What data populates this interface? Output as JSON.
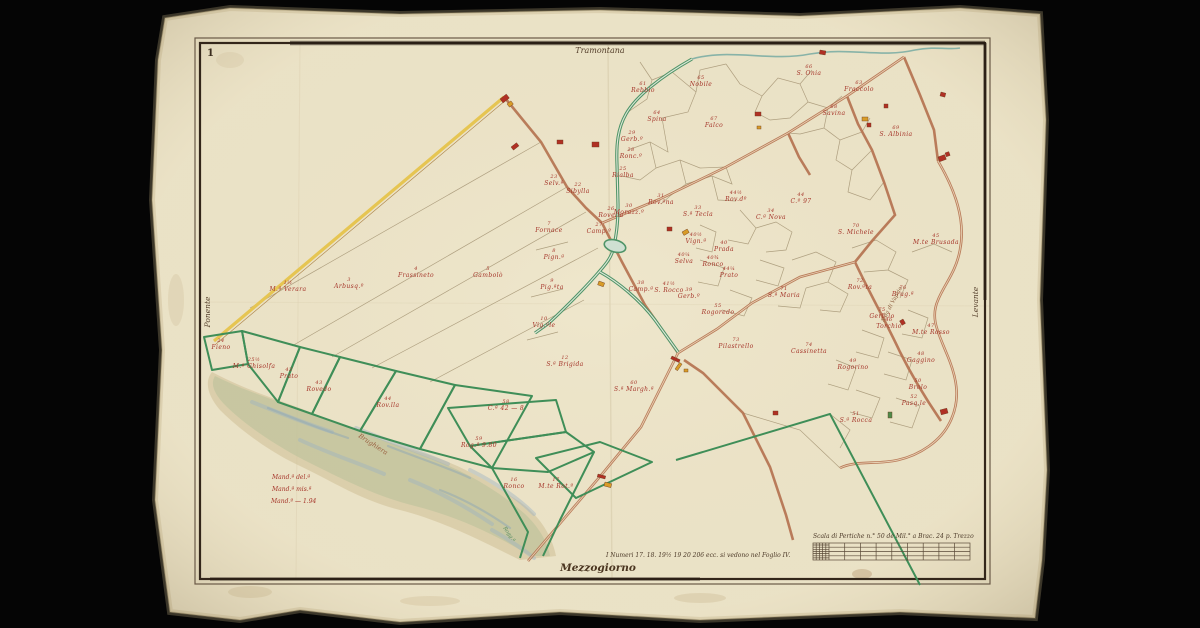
{
  "sheet": {
    "corner_number": "1"
  },
  "cardinals": {
    "north": "Tramontana",
    "south": "Mezzogiorno",
    "west": "Ponente",
    "east": "Levante"
  },
  "footnote": "I Numeri 17. 18. 19½ 19 20 206 ecc. si vedono nel Foglio IV.",
  "scale_bar": {
    "title": "Scala di Pertiche n.° 50 de Mil.° a Brac. 24 p. Trezzo"
  },
  "marsh_note": {
    "lines": [
      "Mand.ª del.ª",
      "Mand.ª mis.ª",
      "Mand.º — 1.94"
    ]
  },
  "annotations": [
    {
      "text": "Brughiera",
      "x": 372,
      "y": 446,
      "rot": 33,
      "size": 6.5,
      "color": "#9a6040"
    },
    {
      "text": "S.da di Vaprio",
      "x": 893,
      "y": 305,
      "rot": -62,
      "size": 5.5,
      "color": "#8a5a3a"
    },
    {
      "text": "Rogg.ª",
      "x": 508,
      "y": 535,
      "rot": 55,
      "size": 5,
      "color": "#4f8a5e"
    }
  ],
  "parcel_labels": [
    {
      "n": "1½",
      "name": "M.ª Verara",
      "x": 288,
      "y": 291
    },
    {
      "n": "3",
      "name": "Arbusq.º",
      "x": 349,
      "y": 288
    },
    {
      "n": "4",
      "name": "Frassineto",
      "x": 416,
      "y": 277
    },
    {
      "n": "5",
      "name": "Gambolò",
      "x": 488,
      "y": 277
    },
    {
      "n": "12",
      "name": "S.ª Brigida",
      "x": 565,
      "y": 366
    },
    {
      "n": "7",
      "name": "Fornace",
      "x": 549,
      "y": 232
    },
    {
      "n": "8",
      "name": "Pign.ª",
      "x": 554,
      "y": 259
    },
    {
      "n": "9",
      "name": "Pig.ªta",
      "x": 552,
      "y": 289
    },
    {
      "n": "10",
      "name": "Vig.ªle",
      "x": 544,
      "y": 327
    },
    {
      "n": "29",
      "name": "Gerb.º",
      "x": 632,
      "y": 141
    },
    {
      "n": "28",
      "name": "Ronc.º",
      "x": 631,
      "y": 158
    },
    {
      "n": "25",
      "name": "Rialba",
      "x": 623,
      "y": 177
    },
    {
      "n": "23",
      "name": "Selv.ª",
      "x": 554,
      "y": 185
    },
    {
      "n": "22",
      "name": "Sibylla",
      "x": 578,
      "y": 193
    },
    {
      "n": "26",
      "name": "Rovella",
      "x": 611,
      "y": 217
    },
    {
      "n": "27",
      "name": "Camp.º",
      "x": 599,
      "y": 233
    },
    {
      "n": "30",
      "name": "Morazz.º",
      "x": 629,
      "y": 214
    },
    {
      "n": "61",
      "name": "Rebbio",
      "x": 643,
      "y": 92
    },
    {
      "n": "64",
      "name": "Spina",
      "x": 657,
      "y": 121
    },
    {
      "n": "65",
      "name": "Nobile",
      "x": 701,
      "y": 86
    },
    {
      "n": "67",
      "name": "Falco",
      "x": 714,
      "y": 127
    },
    {
      "n": "66",
      "name": "S. Onia",
      "x": 809,
      "y": 75
    },
    {
      "n": "63",
      "name": "Fraccolo",
      "x": 859,
      "y": 91
    },
    {
      "n": "68",
      "name": "Savina",
      "x": 834,
      "y": 115
    },
    {
      "n": "69",
      "name": "S. Albinia",
      "x": 896,
      "y": 136
    },
    {
      "n": "31",
      "name": "Rov.ªna",
      "x": 661,
      "y": 204
    },
    {
      "n": "33",
      "name": "S.ª Tecla",
      "x": 698,
      "y": 216
    },
    {
      "n": "44½",
      "name": "Rov.dº",
      "x": 736,
      "y": 201
    },
    {
      "n": "34",
      "name": "C.ª Nova",
      "x": 771,
      "y": 219
    },
    {
      "n": "44",
      "name": "C.º 97",
      "x": 801,
      "y": 203
    },
    {
      "n": "70",
      "name": "S. Michele",
      "x": 856,
      "y": 234
    },
    {
      "n": "40½",
      "name": "Vign.ª",
      "x": 696,
      "y": 243
    },
    {
      "n": "40",
      "name": "Prada",
      "x": 724,
      "y": 251
    },
    {
      "n": "40¼",
      "name": "Selva",
      "x": 684,
      "y": 263
    },
    {
      "n": "40¾",
      "name": "Ronco",
      "x": 713,
      "y": 266
    },
    {
      "n": "44¼",
      "name": "Prato",
      "x": 729,
      "y": 277
    },
    {
      "n": "38",
      "name": "Camp.ª",
      "x": 641,
      "y": 291
    },
    {
      "n": "41½",
      "name": "S. Rocco",
      "x": 669,
      "y": 292
    },
    {
      "n": "71",
      "name": "S.ª Maria",
      "x": 784,
      "y": 297
    },
    {
      "n": "39",
      "name": "Gerb.º",
      "x": 689,
      "y": 298
    },
    {
      "n": "55",
      "name": "Rogoredo",
      "x": 718,
      "y": 314
    },
    {
      "n": "45",
      "name": "M.te Brusada",
      "x": 936,
      "y": 244
    },
    {
      "n": "72",
      "name": "Rov.ªta",
      "x": 860,
      "y": 289
    },
    {
      "n": "76",
      "name": "Brug.ª",
      "x": 903,
      "y": 296
    },
    {
      "n": "75",
      "name": "Gerb.lo",
      "x": 882,
      "y": 318
    },
    {
      "n": "47",
      "name": "M.te Rosso",
      "x": 931,
      "y": 334
    },
    {
      "n": "46",
      "name": "Torchio",
      "x": 889,
      "y": 328
    },
    {
      "n": "48",
      "name": "Gaggino",
      "x": 921,
      "y": 362
    },
    {
      "n": "49",
      "name": "Rogorino",
      "x": 853,
      "y": 369
    },
    {
      "n": "50",
      "name": "Brolo",
      "x": 918,
      "y": 389
    },
    {
      "n": "52",
      "name": "Pasq.le",
      "x": 914,
      "y": 405
    },
    {
      "n": "51",
      "name": "S.ª Rocca",
      "x": 856,
      "y": 422
    },
    {
      "n": "73",
      "name": "Pilastrello",
      "x": 736,
      "y": 348
    },
    {
      "n": "74",
      "name": "Cassinetta",
      "x": 809,
      "y": 353
    },
    {
      "n": "60",
      "name": "S.ª Margh.ª",
      "x": 634,
      "y": 391
    },
    {
      "n": "24",
      "name": "Fieno",
      "x": 221,
      "y": 349
    },
    {
      "n": "25½",
      "name": "M.ª Ghisolfa",
      "x": 254,
      "y": 368
    },
    {
      "n": "42",
      "name": "Prato",
      "x": 289,
      "y": 378
    },
    {
      "n": "43",
      "name": "Rovedo",
      "x": 319,
      "y": 391
    },
    {
      "n": "44",
      "name": "Rov.lla",
      "x": 388,
      "y": 407
    },
    {
      "n": "58",
      "name": "C.ª 42 — 8",
      "x": 506,
      "y": 410
    },
    {
      "n": "59",
      "name": "Rog.ª 9.80",
      "x": 479,
      "y": 447
    },
    {
      "n": "16",
      "name": "Ronco",
      "x": 514,
      "y": 488
    },
    {
      "n": "17",
      "name": "M.te Rot.º",
      "x": 556,
      "y": 488
    }
  ],
  "buildings": [
    {
      "x": 500,
      "y": 99,
      "w": 8,
      "h": 5,
      "rot": -38,
      "c": "red"
    },
    {
      "x": 507,
      "y": 104,
      "w": 5,
      "h": 4,
      "rot": -38,
      "c": "yellow"
    },
    {
      "x": 511,
      "y": 147,
      "w": 7,
      "h": 4,
      "rot": -38,
      "c": "red"
    },
    {
      "x": 557,
      "y": 140,
      "w": 6,
      "h": 4,
      "rot": 0,
      "c": "red"
    },
    {
      "x": 592,
      "y": 142,
      "w": 7,
      "h": 5,
      "rot": 0,
      "c": "red"
    },
    {
      "x": 599,
      "y": 281,
      "w": 6,
      "h": 4,
      "rot": 20,
      "c": "yellow"
    },
    {
      "x": 667,
      "y": 227,
      "w": 5,
      "h": 4,
      "rot": 0,
      "c": "red"
    },
    {
      "x": 682,
      "y": 232,
      "w": 6,
      "h": 4,
      "rot": -30,
      "c": "yellow"
    },
    {
      "x": 755,
      "y": 112,
      "w": 6,
      "h": 4,
      "rot": 0,
      "c": "red"
    },
    {
      "x": 757,
      "y": 126,
      "w": 4,
      "h": 3,
      "rot": 0,
      "c": "yellow"
    },
    {
      "x": 820,
      "y": 50,
      "w": 6,
      "h": 4,
      "rot": 10,
      "c": "red"
    },
    {
      "x": 862,
      "y": 117,
      "w": 6,
      "h": 4,
      "rot": 0,
      "c": "yellow"
    },
    {
      "x": 867,
      "y": 123,
      "w": 4,
      "h": 4,
      "rot": 0,
      "c": "red"
    },
    {
      "x": 884,
      "y": 104,
      "w": 4,
      "h": 4,
      "rot": 0,
      "c": "red"
    },
    {
      "x": 938,
      "y": 157,
      "w": 7,
      "h": 5,
      "rot": -20,
      "c": "red"
    },
    {
      "x": 945,
      "y": 153,
      "w": 4,
      "h": 4,
      "rot": -20,
      "c": "red"
    },
    {
      "x": 941,
      "y": 92,
      "w": 5,
      "h": 4,
      "rot": 15,
      "c": "red"
    },
    {
      "x": 903,
      "y": 319,
      "w": 5,
      "h": 4,
      "rot": 60,
      "c": "red"
    },
    {
      "x": 940,
      "y": 410,
      "w": 7,
      "h": 5,
      "rot": -15,
      "c": "red"
    },
    {
      "x": 888,
      "y": 412,
      "w": 4,
      "h": 6,
      "rot": 0,
      "c": "green"
    },
    {
      "x": 672,
      "y": 356,
      "w": 9,
      "h": 3,
      "rot": 25,
      "c": "red"
    },
    {
      "x": 675,
      "y": 369,
      "w": 8,
      "h": 3,
      "rot": -55,
      "c": "yellow"
    },
    {
      "x": 684,
      "y": 369,
      "w": 4,
      "h": 3,
      "rot": 0,
      "c": "yellow"
    },
    {
      "x": 598,
      "y": 474,
      "w": 8,
      "h": 3,
      "rot": 15,
      "c": "red"
    },
    {
      "x": 605,
      "y": 482,
      "w": 7,
      "h": 4,
      "rot": 15,
      "c": "yellow"
    },
    {
      "x": 773,
      "y": 411,
      "w": 5,
      "h": 4,
      "rot": 0,
      "c": "red"
    }
  ],
  "colors": {
    "paper": "#ece4c9",
    "ink": "#55402c",
    "red_label": "#a5352a",
    "road": "#b4714e",
    "canal": "#4f9468",
    "parcel_green": "#3f8e58",
    "yellow_line": "#e6c552",
    "building_red": "#b03024",
    "building_yellow": "#d89c28",
    "building_green": "#4f8a4a",
    "marsh_green": "#b5c098",
    "marsh_tan": "#cdbf96",
    "marsh_blue": "#9fb4c0"
  }
}
